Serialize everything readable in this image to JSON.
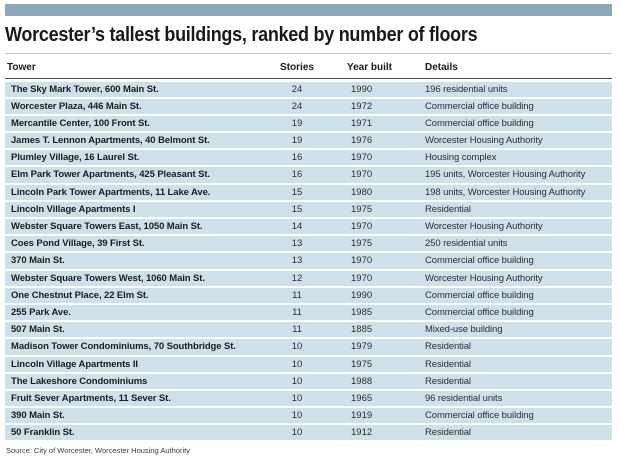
{
  "colors": {
    "top_bar": "#8BA9BB",
    "row_background": "#CEE1EB",
    "header_rule": "#4A4A4A",
    "title_rule": "#C4C4C4",
    "text": "#1A1A1A"
  },
  "chart_data": {
    "type": "table",
    "title": "Worcester’s tallest buildings, ranked by number of floors",
    "columns": [
      "Tower",
      "Stories",
      "Year built",
      "Details"
    ],
    "rows": [
      [
        "The Sky Mark Tower, 600 Main St.",
        "24",
        "1990",
        "196 residential units"
      ],
      [
        "Worcester Plaza, 446 Main St.",
        "24",
        "1972",
        "Commercial office building"
      ],
      [
        "Mercantile Center, 100 Front St.",
        "19",
        "1971",
        "Commercial office building"
      ],
      [
        "James T. Lennon Apartments, 40 Belmont St.",
        "19",
        "1976",
        "Worcester Housing Authority"
      ],
      [
        "Plumley Village, 16 Laurel St.",
        "16",
        "1970",
        "Housing complex"
      ],
      [
        "Elm Park Tower Apartments, 425 Pleasant St.",
        "16",
        "1970",
        "195 units, Worcester Housing Authority"
      ],
      [
        "Lincoln Park Tower Apartments, 11 Lake Ave.",
        "15",
        "1980",
        "198 units, Worcester Housing Authority"
      ],
      [
        "Lincoln Village Apartments I",
        "15",
        "1975",
        "Residential"
      ],
      [
        "Webster Square Towers East, 1050 Main St.",
        "14",
        "1970",
        "Worcester Housing Authority"
      ],
      [
        "Coes Pond Village, 39 First St.",
        "13",
        "1975",
        "250 residential units"
      ],
      [
        "370 Main St.",
        "13",
        "1970",
        "Commercial office building"
      ],
      [
        "Webster Square Towers West, 1060 Main St.",
        "12",
        "1970",
        "Worcester Housing Authority"
      ],
      [
        "One Chestnut Place, 22 Elm St.",
        "11",
        "1990",
        "Commercial office building"
      ],
      [
        "255 Park Ave.",
        "11",
        "1985",
        "Commercial office building"
      ],
      [
        "507 Main St.",
        "11",
        "1885",
        "Mixed-use building"
      ],
      [
        "Madison Tower Condominiums, 70 Southbridge St.",
        "10",
        "1979",
        "Residential"
      ],
      [
        "Lincoln Village Apartments II",
        "10",
        "1975",
        "Residential"
      ],
      [
        "The Lakeshore Condominiums",
        "10",
        "1988",
        "Residential"
      ],
      [
        "Fruit Sever Apartments, 11 Sever St.",
        "10",
        "1965",
        "96 residential units"
      ],
      [
        "390 Main St.",
        "10",
        "1919",
        "Commercial office building"
      ],
      [
        "50 Franklin St.",
        "10",
        "1912",
        "Residential"
      ]
    ],
    "source": "Source: City of Worcester, Worcester Housing Authority",
    "layout": {
      "grid": "off",
      "row_striping": "uniform-light-blue",
      "header_position": "top"
    }
  }
}
